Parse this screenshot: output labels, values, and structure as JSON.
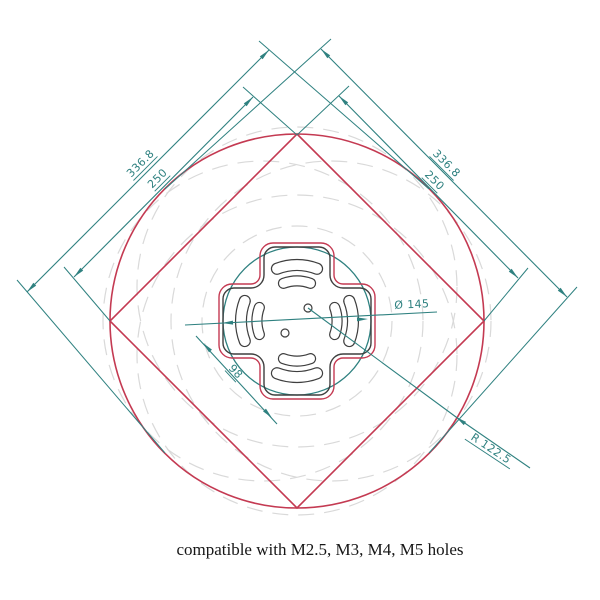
{
  "caption": "compatible with M2.5, M3, M4, M5 holes",
  "dims": {
    "left_outer": "336.8",
    "left_inner": "250",
    "right_outer": "336.8",
    "right_inner": "250",
    "diameter": "Ø 145",
    "width": "98",
    "radius": "R 122.5"
  },
  "colors": {
    "outline_red": "#c43a52",
    "dimension_teal": "#2f8180",
    "construction_gray": "#d9d9d9",
    "plate_black": "#3f3f3f",
    "caption_black": "#161616"
  }
}
